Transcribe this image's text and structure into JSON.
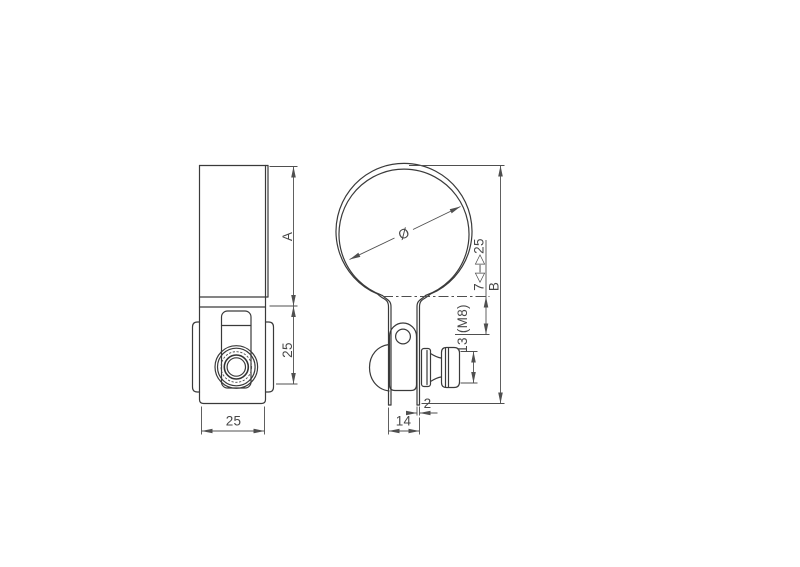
{
  "drawing": {
    "colors": {
      "background": "#ffffff",
      "outline": "#3a3a3a",
      "dimension_lines": "#4f4f4f",
      "text": "#474747"
    },
    "front_view": {
      "band_height_label": "A",
      "bracket_height_label": "25",
      "width_label": "25"
    },
    "side_view": {
      "diameter_label": "Ø",
      "total_height_label": "B",
      "adjust_range_label": "7◁–▷25",
      "bolt_label": "13 (M8)",
      "material_thickness_label": "2",
      "leg_span_label": "14"
    }
  }
}
